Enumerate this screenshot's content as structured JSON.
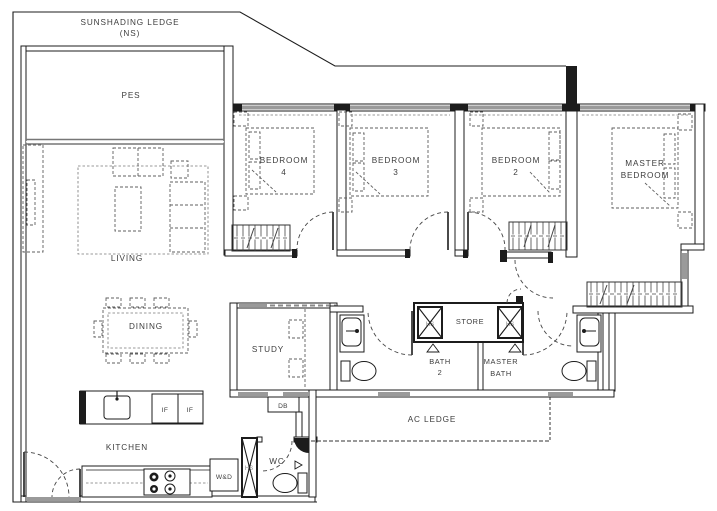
{
  "plan": {
    "ledge": {
      "line1": "SUNSHADING LEDGE",
      "line2": "(NS)"
    },
    "rooms": {
      "pes": "PES",
      "living": "LIVING",
      "dining": "DINING",
      "kitchen": "KITCHEN",
      "study": "STUDY",
      "store": "STORE",
      "wc": "WC",
      "ac_ledge": "AC LEDGE",
      "bedroom4": {
        "line1": "BEDROOM",
        "line2": "4"
      },
      "bedroom3": {
        "line1": "BEDROOM",
        "line2": "3"
      },
      "bedroom2": {
        "line1": "BEDROOM",
        "line2": "2"
      },
      "master_bedroom": {
        "line1": "MASTER",
        "line2": "BEDROOM"
      },
      "bath2": {
        "line1": "BATH",
        "line2": "2"
      },
      "master_bath": {
        "line1": "MASTER",
        "line2": "BATH"
      }
    },
    "fixtures": {
      "washer_dryer": "W&D",
      "distribution_board": "DB",
      "fridge_left": "IF",
      "fridge_right": "IF",
      "heater_bath2": "HS",
      "heater_master": "HS",
      "heater_kitchen": "HS"
    },
    "colors": {
      "wall": "#1c1c1c",
      "window": "#9a9a9a",
      "furniture": "#5f5f5f",
      "label": "#3d3d3d"
    }
  }
}
